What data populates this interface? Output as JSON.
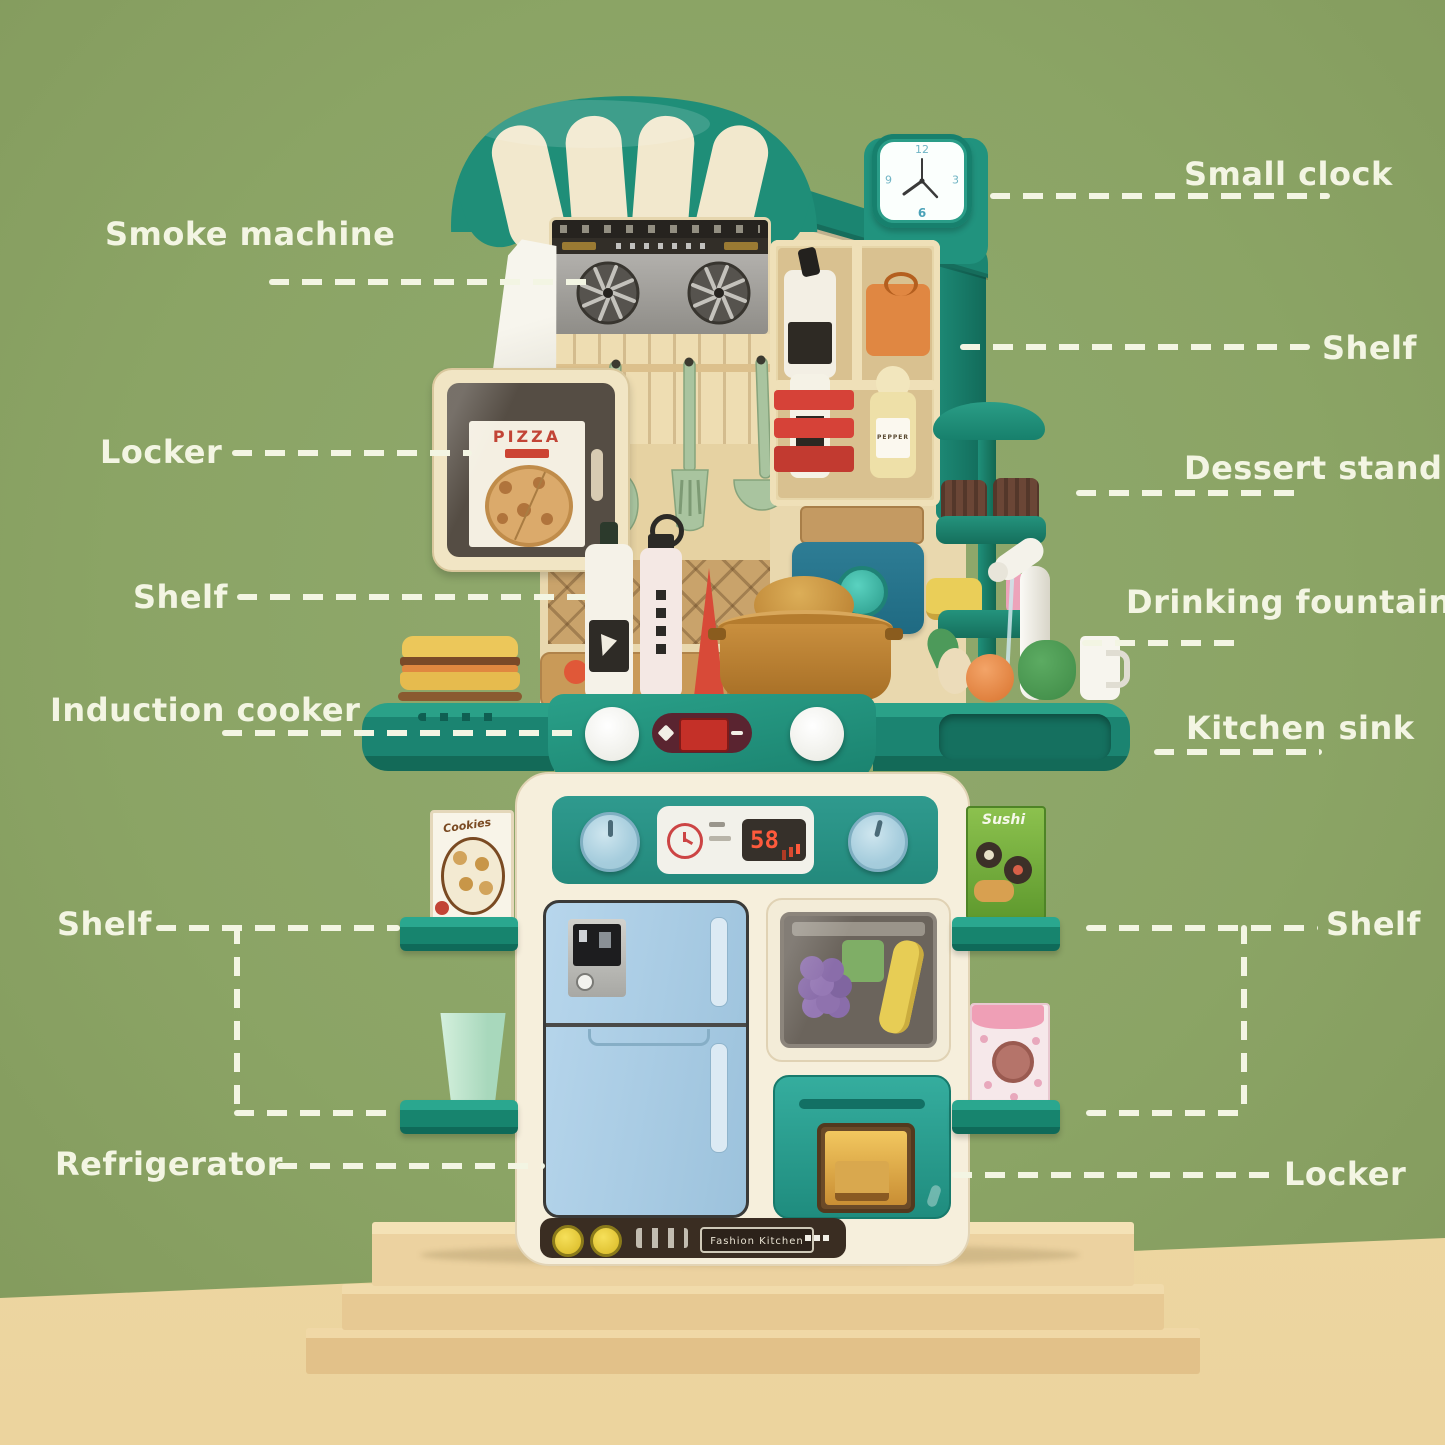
{
  "scene": {
    "background_color": "#8ba465",
    "floor_color": "#f2dfae",
    "label_text_color": "#f3f5e3",
    "awning_teal": "#1f8e78",
    "counter_teal": "#1f8f7b",
    "fridge_blue": "#a9cbe3",
    "oven_teal": "#2aa295"
  },
  "labels": {
    "smoke_machine": "Smoke machine",
    "small_clock": "Small clock",
    "shelf_top_right": "Shelf",
    "locker_left": "Locker",
    "dessert_stand": "Dessert stand",
    "shelf_mid_left": "Shelf",
    "drinking_fountain": "Drinking fountain",
    "induction_cooker": "Induction cooker",
    "kitchen_sink": "Kitchen sink",
    "shelf_bottom_left": "Shelf",
    "shelf_bottom_right": "Shelf",
    "refrigerator": "Refrigerator",
    "locker_bottom_right": "Locker"
  },
  "kitchen": {
    "clock": {
      "twelve": "12",
      "three": "3",
      "six": "6",
      "nine": "9"
    },
    "pizza_sign": "PIZZA",
    "pepper_label": "PEPPER",
    "timer_display": "58",
    "brand_label": "Fashion Kitchen",
    "cookies_card": "Cookies",
    "sushi_card": "Sushi"
  }
}
